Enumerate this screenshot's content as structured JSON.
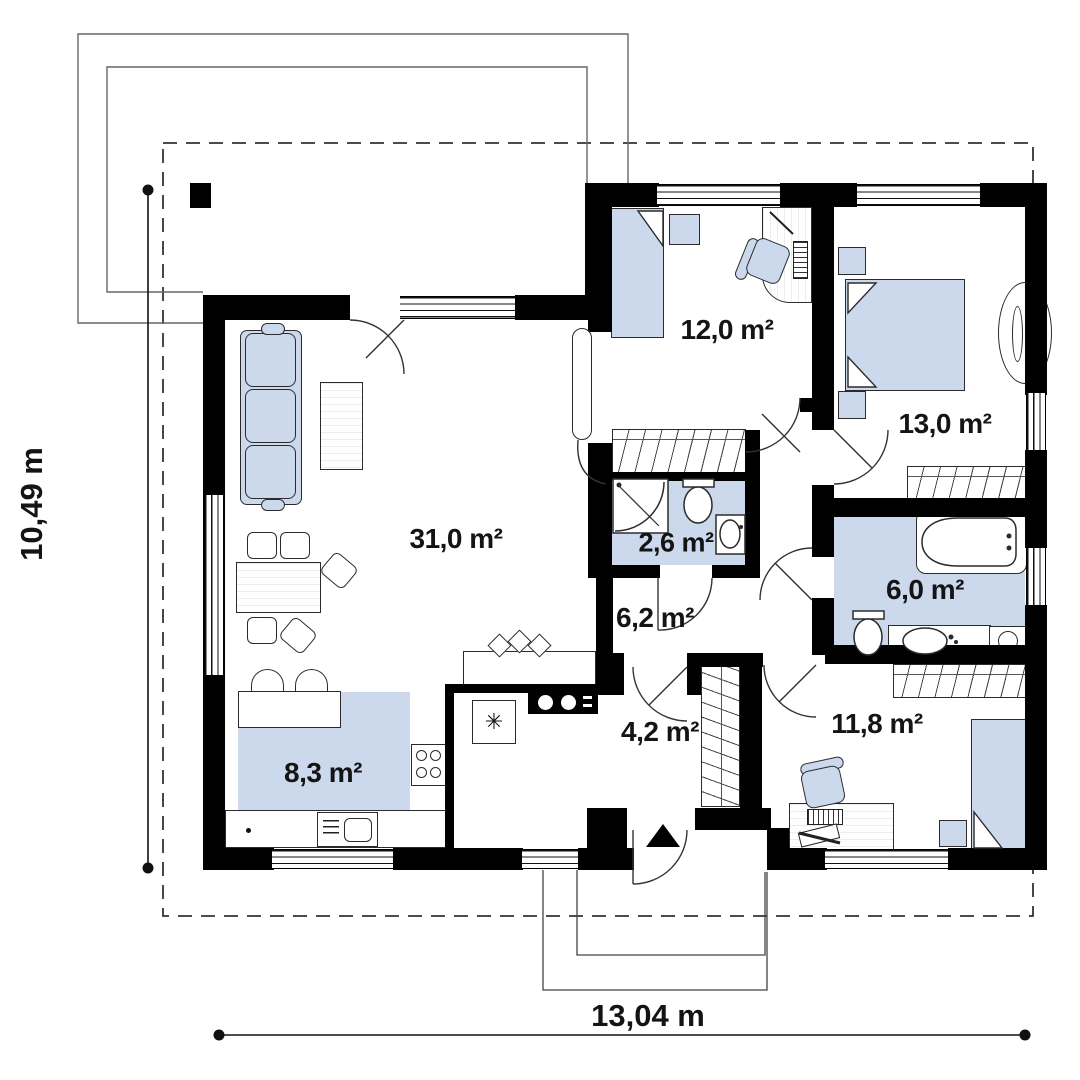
{
  "plan_title": "single-storey house floor plan",
  "rooms": {
    "living_room": {
      "label": "31,0 m²"
    },
    "bedroom_12": {
      "label": "12,0 m²"
    },
    "bedroom_13": {
      "label": "13,0 m²"
    },
    "wc": {
      "label": "2,6 m²"
    },
    "hallway": {
      "label": "6,2 m²"
    },
    "bathroom": {
      "label": "6,0 m²"
    },
    "kitchen": {
      "label": "8,3 m²"
    },
    "vestibule": {
      "label": "4,2 m²"
    },
    "bedroom_11": {
      "label": "11,8 m²"
    },
    "total_width": {
      "label": "13,04 m"
    },
    "total_height": {
      "label": "10,49 m"
    }
  },
  "colors": {
    "wall": "#000000",
    "fixture_fill": "#ccd9ec",
    "outline": "#555555"
  }
}
